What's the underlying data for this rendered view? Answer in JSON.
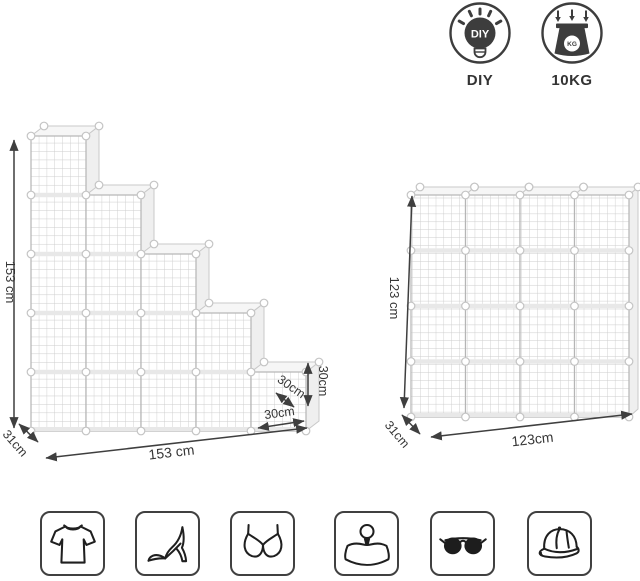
{
  "badges": {
    "diy": {
      "label": "DIY",
      "bulb_text": "DIY"
    },
    "weight": {
      "label": "10KG",
      "unit_text": "KG"
    }
  },
  "stair_unit": {
    "columns": [
      5,
      4,
      3,
      2,
      1
    ],
    "cube_count": 15,
    "height_label": "153 cm",
    "width_label": "153 cm",
    "depth_label": "31cm",
    "cube_width_label": "30cm",
    "cube_height_label": "30cm",
    "cube_depth_label": "30cm"
  },
  "grid_unit": {
    "rows": 4,
    "cols": 4,
    "cube_count": 16,
    "height_label": "123 cm",
    "width_label": "123cm",
    "depth_label": "31cm"
  },
  "category_icons": [
    {
      "name": "tshirt"
    },
    {
      "name": "high-heel"
    },
    {
      "name": "bra"
    },
    {
      "name": "handbag"
    },
    {
      "name": "sunglasses"
    },
    {
      "name": "baseball-cap"
    }
  ],
  "colors": {
    "wire": "#c9c9c9",
    "mesh": "#cdcdcd",
    "face_stroke": "#b5b5b5",
    "shelf": "#e8e8e8",
    "side_face": "#efefef",
    "top_face": "#f6f6f6",
    "ball_fill": "#ffffff",
    "ball_stroke": "#c4c4c4",
    "arrow": "#3f3f3f",
    "ink": "#3a3a3a"
  }
}
